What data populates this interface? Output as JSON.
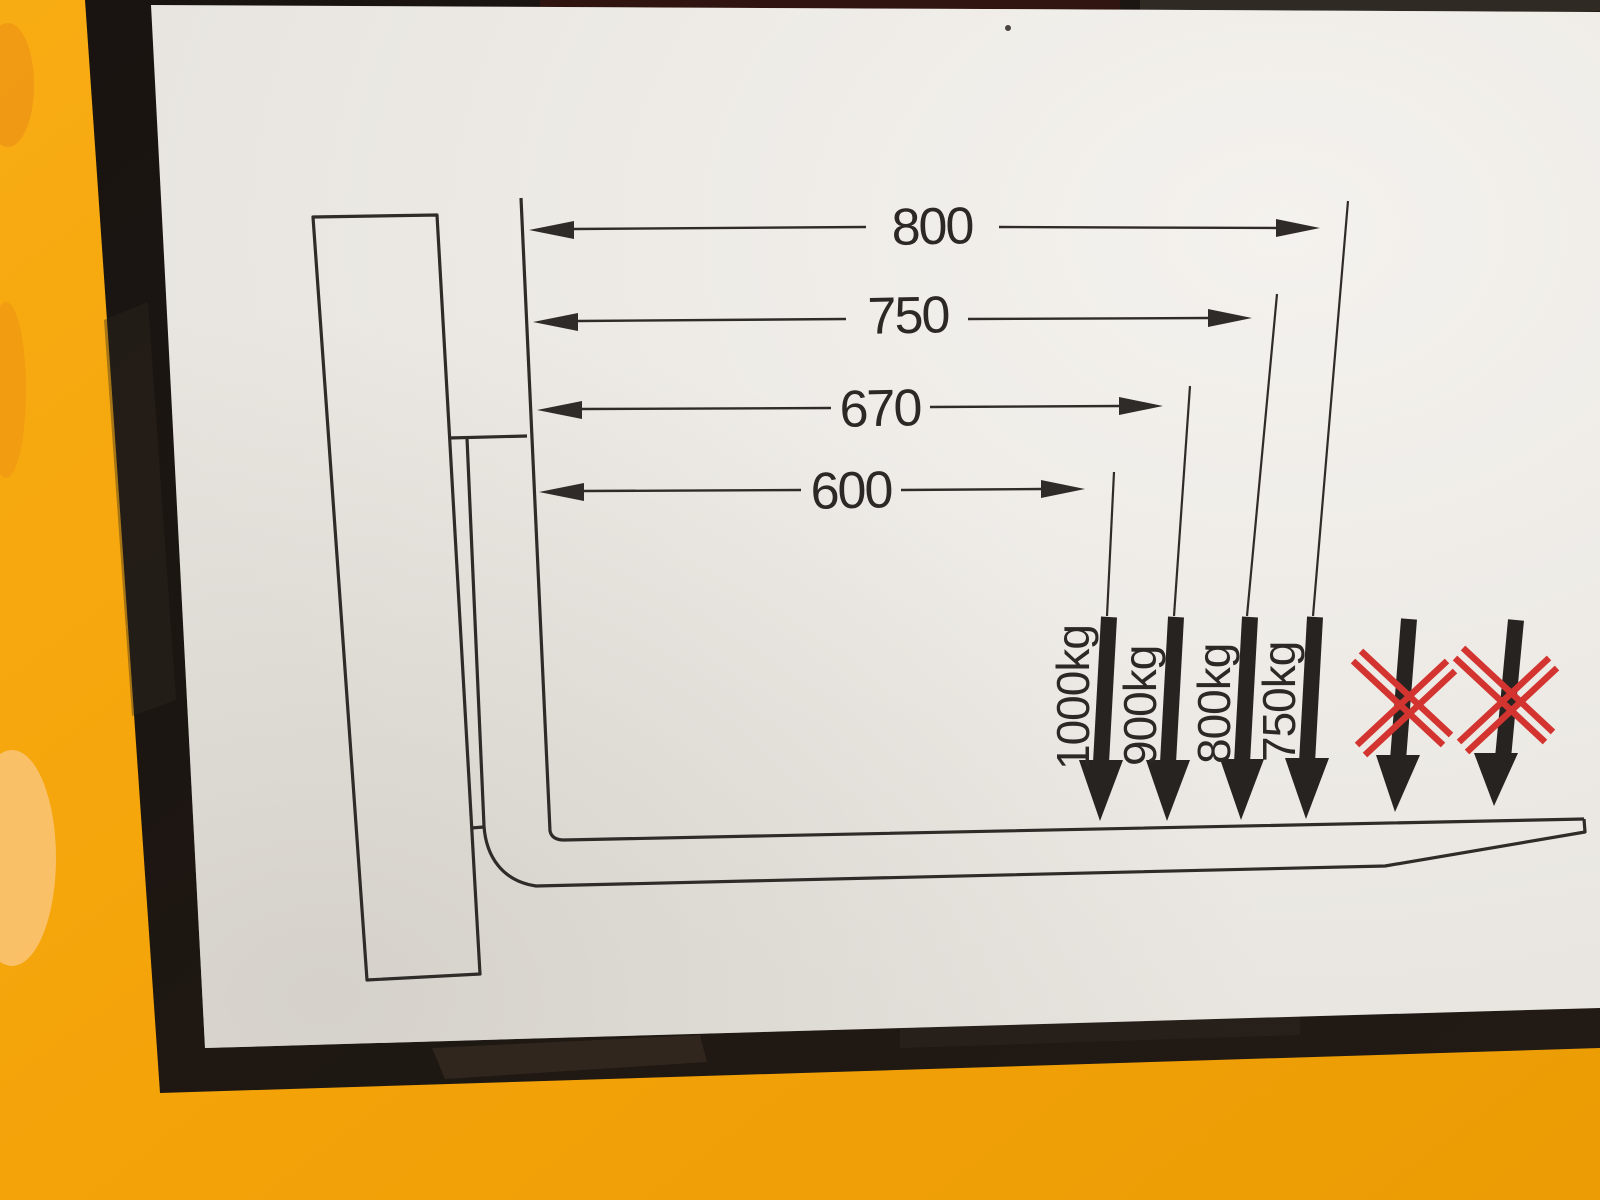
{
  "diagram": {
    "dimension_labels": [
      "800",
      "750",
      "670",
      "600"
    ],
    "load_labels": [
      "1000kg",
      "900kg",
      "800kg",
      "750kg"
    ],
    "icons": {
      "load_arrow": "down-arrow-icon",
      "dimension_arrow": "double-headed-dimension-arrow-icon",
      "prohibited": "red-x-icon"
    },
    "colors": {
      "machine_yellow": "#F4A50B",
      "label_background": "#E9E6E1",
      "line_ink": "#2E2B28",
      "border_black": "#171311",
      "prohibited_red": "#D33430"
    }
  },
  "chart_data": {
    "type": "table",
    "columns": [
      "load_center_distance",
      "capacity"
    ],
    "rows": [
      [
        "600",
        "1000kg"
      ],
      [
        "670",
        "900kg"
      ],
      [
        "750",
        "800kg"
      ],
      [
        "800",
        "750kg"
      ]
    ]
  }
}
